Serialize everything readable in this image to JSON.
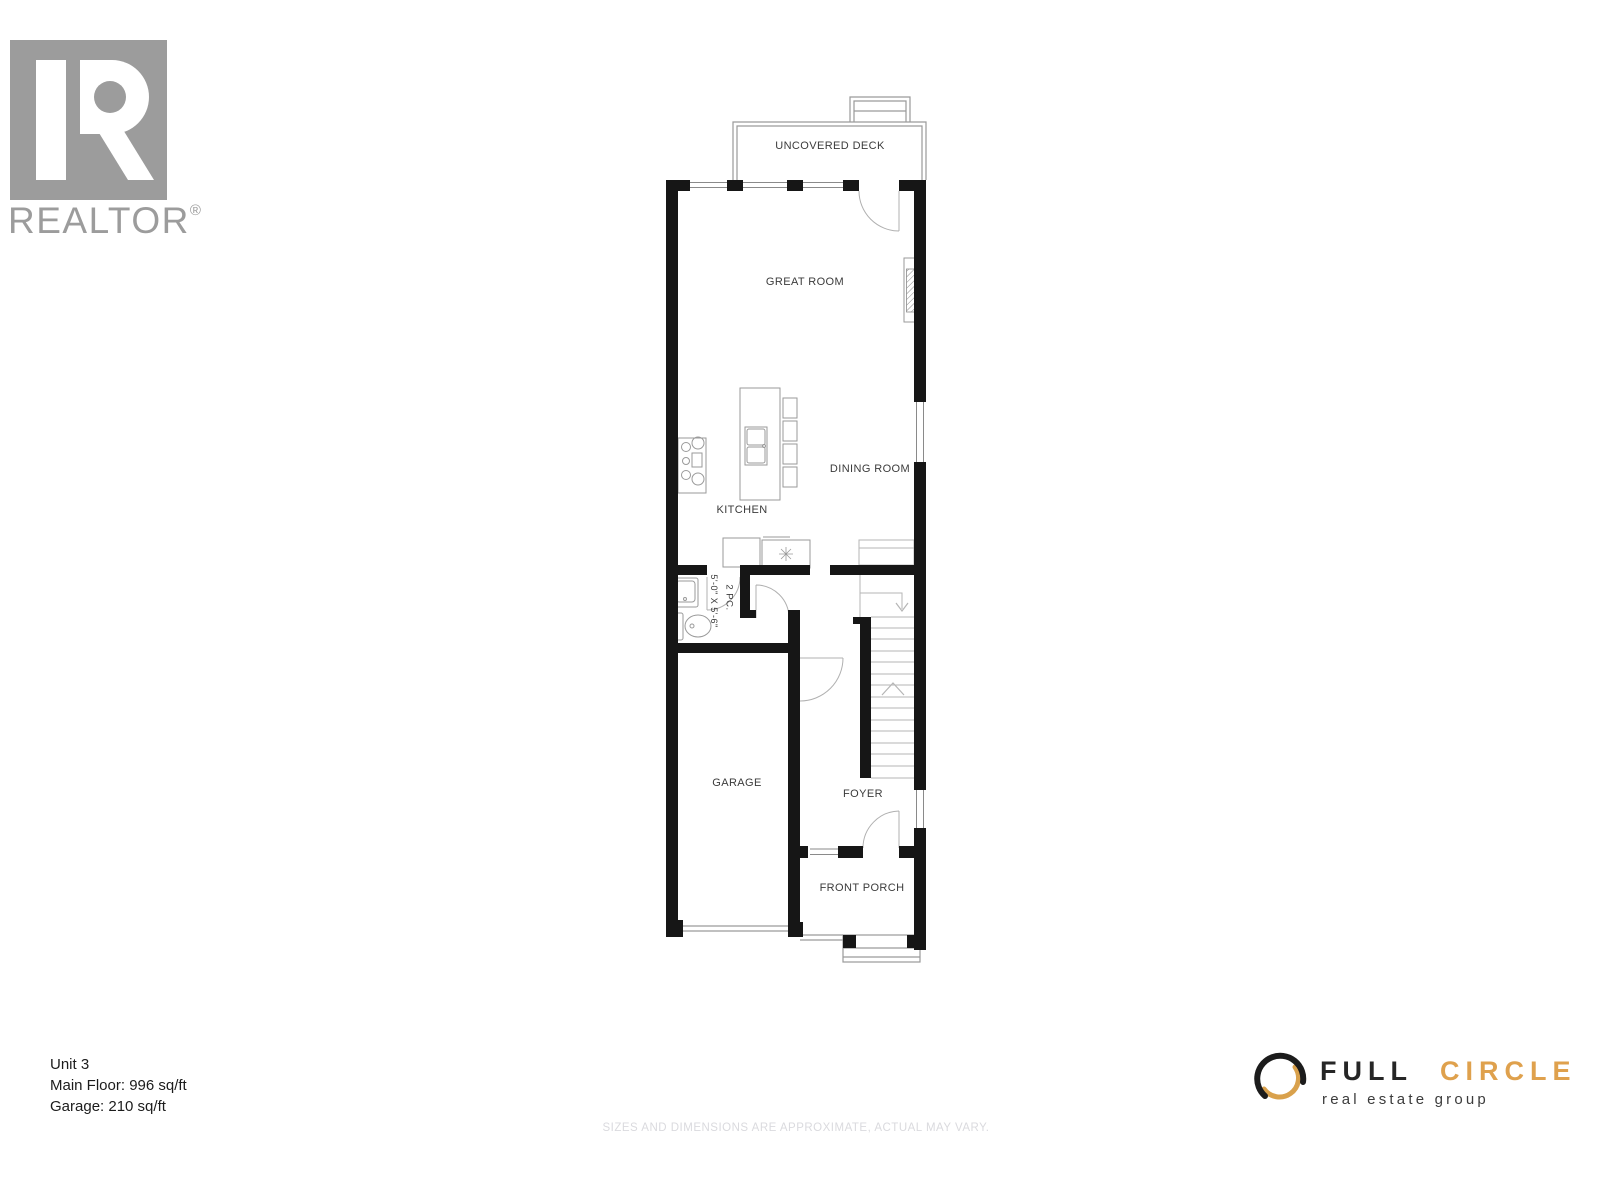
{
  "branding": {
    "realtor": {
      "wordmark": "REALTOR",
      "registered": "®",
      "color": "#9c9c9c"
    },
    "full_circle": {
      "word1": "FULL",
      "word2": "CIRCLE",
      "tagline": "real estate group",
      "accent_color": "#D9A14C",
      "dark_color": "#1f1f1f"
    }
  },
  "unit_info": {
    "unit_label": "Unit 3",
    "main_floor_label": "Main Floor: 996 sq/ft",
    "garage_label": "Garage: 210 sq/ft"
  },
  "disclaimer": "SIZES AND DIMENSIONS ARE APPROXIMATE, ACTUAL MAY VARY.",
  "floor_plan": {
    "labels": {
      "deck": "UNCOVERED DECK",
      "great_room": "GREAT ROOM",
      "dining_room": "DINING ROOM",
      "kitchen": "KITCHEN",
      "garage": "GARAGE",
      "foyer": "FOYER",
      "front_porch": "FRONT PORCH",
      "powder_room": "2 PC.",
      "powder_dims": "5'-0\" X 5'-6\""
    }
  }
}
